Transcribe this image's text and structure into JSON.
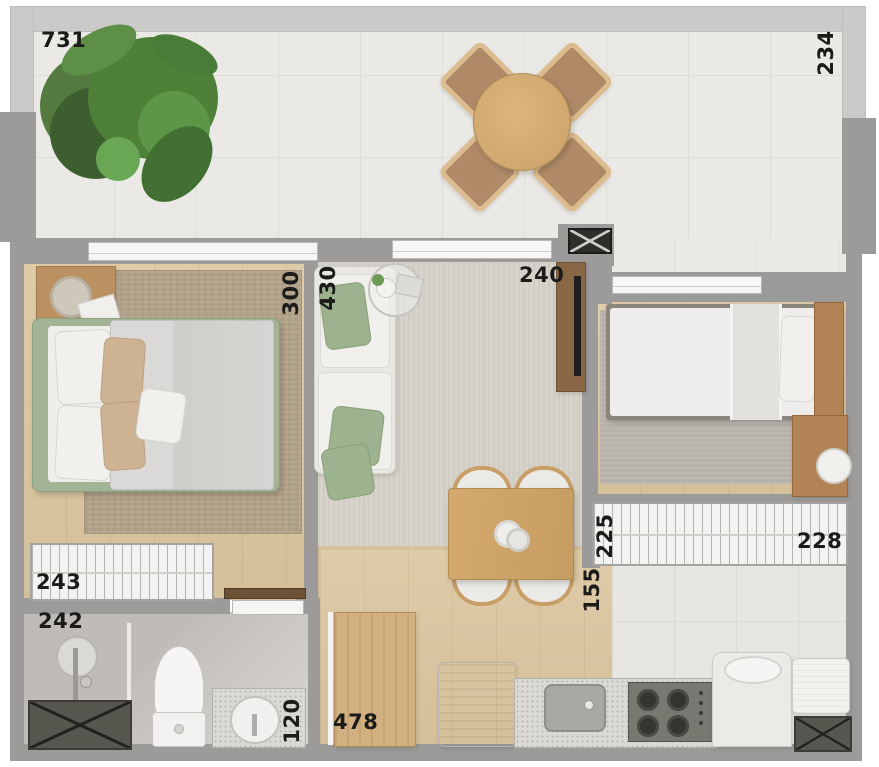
{
  "dimensions": {
    "balcony_width": "731",
    "balcony_depth": "234",
    "bedroom1_depth": "300",
    "bedroom1_width": "243",
    "living_depth": "430",
    "living_width": "240",
    "bathroom_length": "242",
    "bathroom_width": "120",
    "wardrobe_depth": "225",
    "wardrobe_width": "228",
    "kitchen_corridor_width": "155",
    "kitchen_length": "478"
  },
  "colors": {
    "wall_outer": "#cbcac8",
    "wall_inner": "#9c9b99",
    "balcony_tile": "#ebe9e6",
    "wood_floor": "#dcc7a0",
    "bedroom_rug": "#b2a289",
    "living_rug": "#d7d3ca",
    "accent_sage": "#9db28f",
    "granite": "#dbd9d5",
    "label_ink": "#1b1b19"
  }
}
